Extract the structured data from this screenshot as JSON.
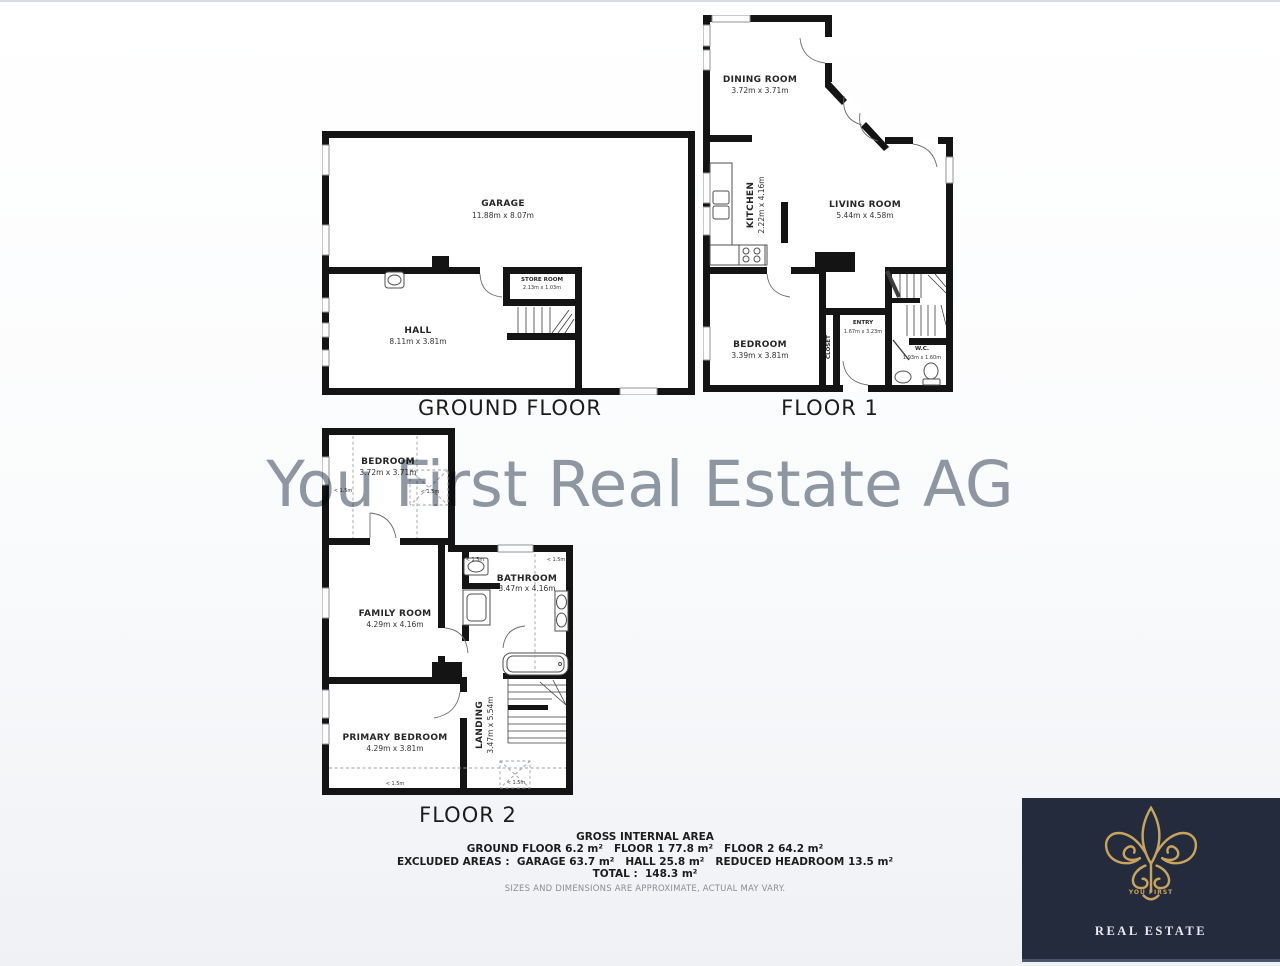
{
  "watermark": {
    "text": "You First Real Estate AG",
    "color": "#78828f"
  },
  "floors": {
    "ground": {
      "title": "GROUND FLOOR",
      "rooms": {
        "garage": {
          "name": "GARAGE",
          "dims": "11.88m x 8.07m"
        },
        "hall": {
          "name": "HALL",
          "dims": "8.11m x 3.81m"
        },
        "store": {
          "name": "STORE ROOM",
          "dims": "2.13m x 1.03m"
        }
      }
    },
    "floor1": {
      "title": "FLOOR 1",
      "rooms": {
        "dining": {
          "name": "DINING ROOM",
          "dims": "3.72m x 3.71m"
        },
        "kitchen": {
          "name": "KITCHEN",
          "dims": "2.22m x 4.16m"
        },
        "living": {
          "name": "LIVING ROOM",
          "dims": "5.44m x 4.58m"
        },
        "bedroom": {
          "name": "BEDROOM",
          "dims": "3.39m x 3.81m"
        },
        "entry": {
          "name": "ENTRY",
          "dims": "1.67m x 3.23m"
        },
        "wc": {
          "name": "W.C.",
          "dims": "1.93m x 1.60m"
        },
        "closet": {
          "name": "CLOSET"
        }
      }
    },
    "floor2": {
      "title": "FLOOR 2",
      "headroom_label": "< 1.5m",
      "rooms": {
        "bedroom": {
          "name": "BEDROOM",
          "dims": "3.72m x 3.71m"
        },
        "family": {
          "name": "FAMILY ROOM",
          "dims": "4.29m x 4.16m"
        },
        "bathroom": {
          "name": "BATHROOM",
          "dims": "3.47m x 4.16m"
        },
        "primary": {
          "name": "PRIMARY BEDROOM",
          "dims": "4.29m x 3.81m"
        },
        "landing": {
          "name": "LANDING",
          "dims": "3.47m x 5.54m"
        }
      }
    }
  },
  "summary": {
    "title": "GROSS INTERNAL AREA",
    "line1": "GROUND FLOOR 6.2 m²   FLOOR 1 77.8 m²   FLOOR 2 64.2 m²",
    "line2": "EXCLUDED AREAS :  GARAGE 63.7 m²   HALL 25.8 m²   REDUCED HEADROOM 13.5 m²",
    "line3": "TOTAL :  148.3 m²",
    "disclaimer": "SIZES AND DIMENSIONS ARE APPROXIMATE, ACTUAL MAY VARY."
  },
  "logo": {
    "brand_top": "YOU FIRST",
    "brand_bottom": "REAL ESTATE",
    "colors": {
      "bg": "#232b3d",
      "gold": "#c9a45c",
      "text": "#e7eaf0"
    }
  },
  "colors": {
    "wall": "#141414",
    "watermark": "#78828f",
    "page_bottom": "#eff1f5"
  }
}
